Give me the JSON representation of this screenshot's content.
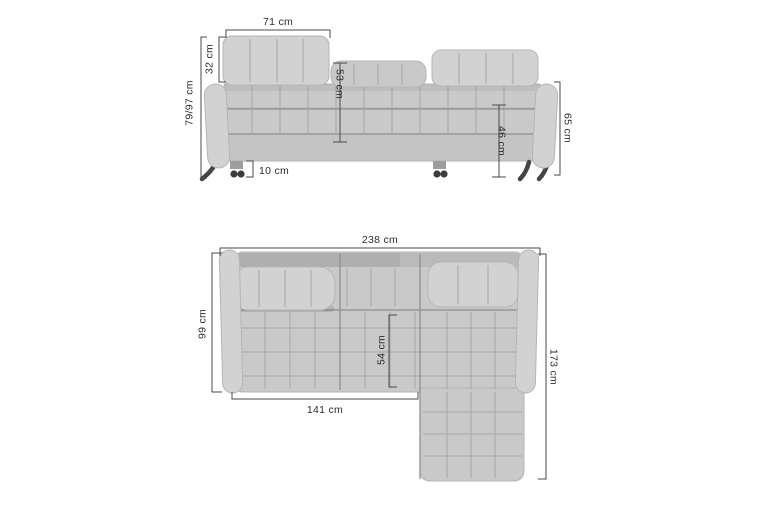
{
  "front_view": {
    "labels": {
      "headrest_width": "71 cm",
      "headrest_height": "32 cm",
      "total_height": "79/97 cm",
      "backrest_height": "53 cm",
      "seat_height": "46 cm",
      "armrest_height": "65 cm",
      "leg_height": "10 cm"
    }
  },
  "top_view": {
    "labels": {
      "total_width": "238 cm",
      "depth": "99 cm",
      "total_length": "173 cm",
      "seat_width": "141 cm",
      "seat_depth": "54 cm"
    }
  },
  "colors": {
    "background": "#ffffff",
    "sofa_body": "#c9c9c9",
    "sofa_light": "#d2d2d2",
    "sofa_base": "#c4c4c4",
    "seam": "#a6a6a6",
    "divider": "#8f8f8f",
    "dimension_line": "#4a4a4a",
    "label_text": "#2d2d2d",
    "legs": "#454545"
  }
}
